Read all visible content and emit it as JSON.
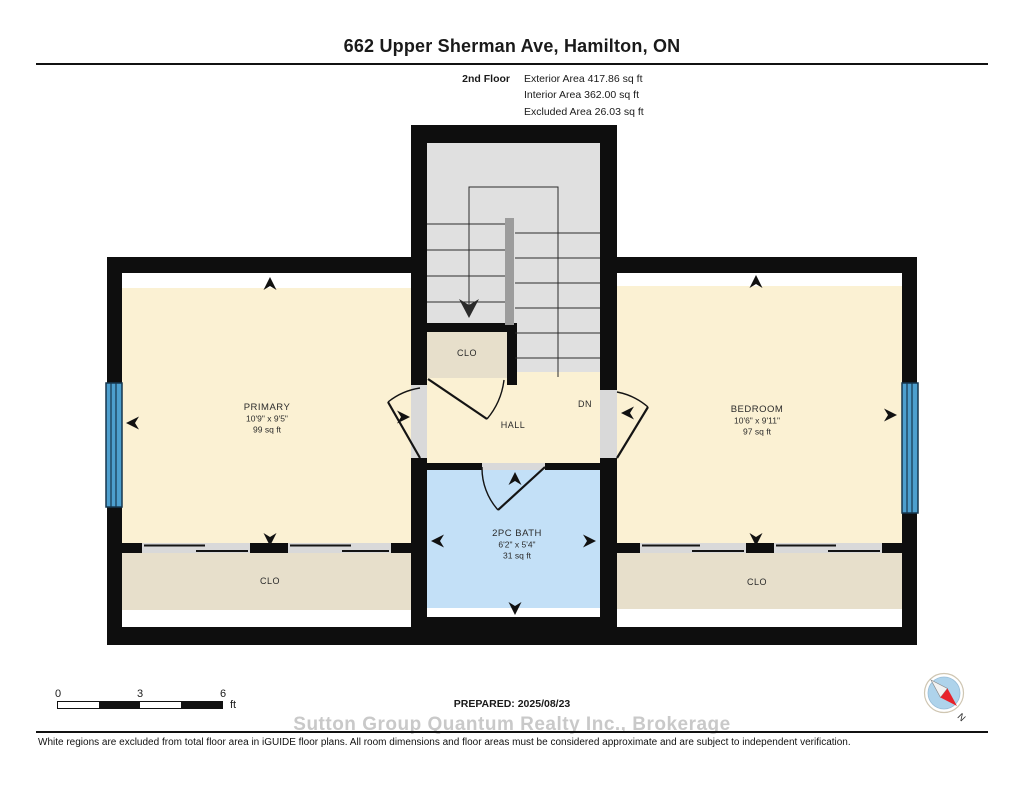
{
  "title": "662 Upper Sherman Ave, Hamilton, ON",
  "floor_info": {
    "floor": "2nd Floor",
    "exterior": "Exterior Area 417.86 sq ft",
    "interior": "Interior Area 362.00 sq ft",
    "excluded": "Excluded Area 26.03 sq ft"
  },
  "rooms": {
    "primary": {
      "name": "PRIMARY",
      "dims": "10'9\" x 9'5\"",
      "area": "99 sq ft"
    },
    "bedroom": {
      "name": "BEDROOM",
      "dims": "10'6\" x 9'11\"",
      "area": "97 sq ft"
    },
    "bath": {
      "name": "2PC BATH",
      "dims": "6'2\" x 5'4\"",
      "area": "31 sq ft"
    },
    "hall": {
      "name": "HALL"
    },
    "stairs": {
      "direction": "DN"
    },
    "closet_mid": {
      "name": "CLO"
    },
    "closet_left": {
      "name": "CLO"
    },
    "closet_right": {
      "name": "CLO"
    }
  },
  "scale_bar": {
    "ticks": [
      "0",
      "3",
      "6"
    ],
    "unit": "ft"
  },
  "prepared": "PREPARED: 2025/08/23",
  "watermark": "Sutton Group Quantum Realty Inc., Brokerage",
  "compass": {
    "label": "N"
  },
  "disclaimer": "White regions are excluded from total floor area in iGUIDE floor plans. All room dimensions and floor areas must be considered approximate and are subject to independent verification.",
  "colors": {
    "room_cream": "#FBF1D3",
    "closet_tan": "#E7DFCB",
    "bath_blue": "#C3E0F7",
    "stairs_gray": "#E0E0E0",
    "threshold_gray": "#D9D9D9",
    "window_blue": "#4D9FCE",
    "wall_black": "#0E0E0E",
    "compass_red": "#E8222A",
    "compass_disc": "#AED3EB"
  }
}
